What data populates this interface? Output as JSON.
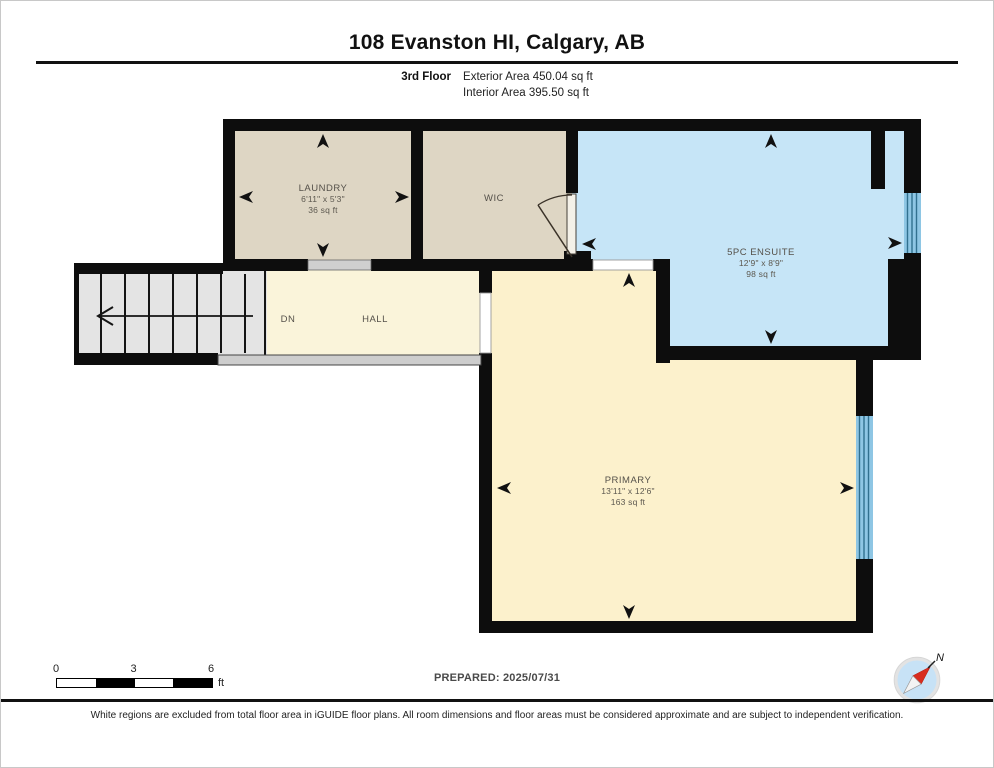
{
  "header": {
    "title": "108 Evanston HI, Calgary, AB",
    "floor": "3rd Floor",
    "area_line1": "Exterior Area 450.04 sq ft",
    "area_line2": "Interior Area 395.50 sq ft"
  },
  "rooms": {
    "laundry": {
      "name": "LAUNDRY",
      "dims": "6'11\" x 5'3\"",
      "area": "36 sq ft"
    },
    "wic": {
      "name": "WIC"
    },
    "ensuite": {
      "name": "5PC ENSUITE",
      "dims": "12'9\" x 8'9\"",
      "area": "98 sq ft"
    },
    "hall": {
      "name": "HALL",
      "stairs_label": "DN"
    },
    "primary": {
      "name": "PRIMARY",
      "dims": "13'11\" x 12'6\"",
      "area": "163 sq ft"
    }
  },
  "scale_bar": {
    "tick0": "0",
    "tick1": "3",
    "tick2": "6",
    "unit": "ft"
  },
  "footer": {
    "prepared": "PREPARED: 2025/07/31",
    "disclaimer": "White regions are excluded from total floor area in iGUIDE floor plans. All room dimensions and floor areas must be considered approximate and are subject to independent verification."
  },
  "compass": {
    "label": "N"
  },
  "colors": {
    "laundry": "#ded6c4",
    "wic": "#ded6c4",
    "ensuite": "#c6e5f7",
    "hall": "#faf4da",
    "primary": "#fcf1cc",
    "stairs": "#e4e4e4",
    "window_fill": "#8ec6e4",
    "window_line": "#31708f",
    "threshold_gray": "#cfcfcf",
    "railing_gray": "#cdcdcd"
  }
}
